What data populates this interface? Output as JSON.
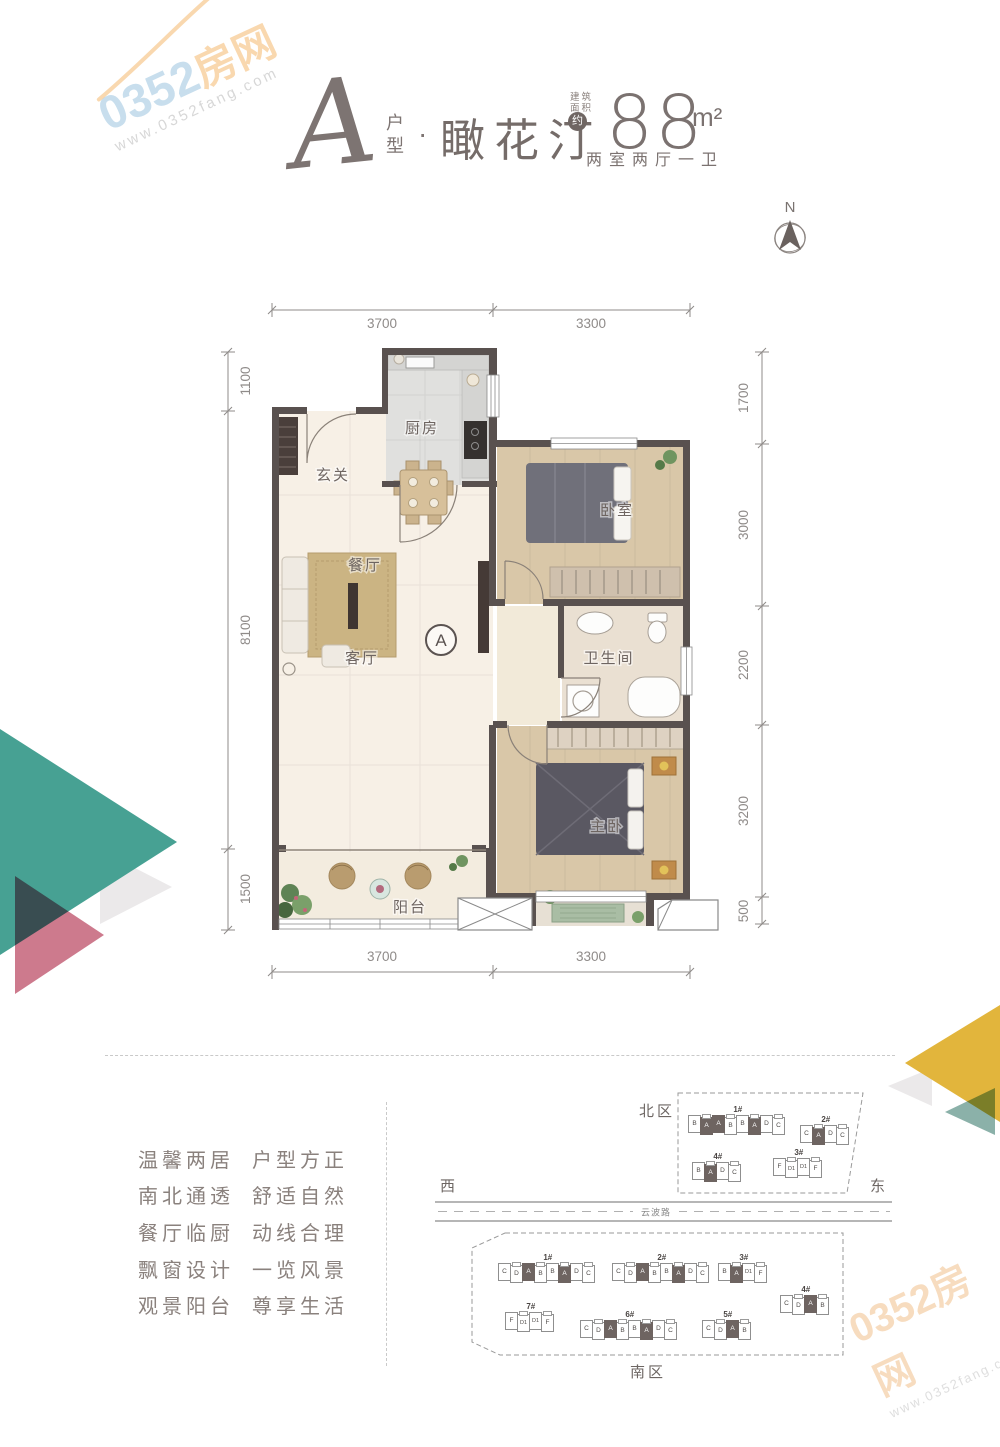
{
  "watermark": {
    "brand_num": "0352",
    "brand_cn": "房网",
    "url": "www.0352fang.com"
  },
  "header": {
    "unit_letter": "A",
    "unit_label_line1": "户",
    "unit_label_line2": "型",
    "separator": "·",
    "name": "瞰花汀",
    "area_note_line1": "建筑",
    "area_note_line2": "面积",
    "approx": "约",
    "area_value": "88",
    "area_unit": "m²",
    "layout_text": "两室两厅一卫"
  },
  "compass": {
    "north": "N"
  },
  "plan": {
    "rooms": {
      "kitchen": "厨房",
      "entry": "玄关",
      "dining": "餐厅",
      "living": "客厅",
      "bedroom": "卧室",
      "bath": "卫生间",
      "master": "主卧",
      "balcony": "阳台",
      "marker": "A"
    },
    "dims": {
      "top": [
        "3700",
        "3300"
      ],
      "bottom": [
        "3700",
        "3300"
      ],
      "left": [
        "1100",
        "8100",
        "1500"
      ],
      "right": [
        "1700",
        "3000",
        "2200",
        "3200",
        "500"
      ]
    }
  },
  "features": {
    "rows": [
      {
        "l": "温馨两居",
        "r": "户型方正"
      },
      {
        "l": "南北通透",
        "r": "舒适自然"
      },
      {
        "l": "餐厅临厨",
        "r": "动线合理"
      },
      {
        "l": "飘窗设计",
        "r": "一览风景"
      },
      {
        "l": "观景阳台",
        "r": "尊享生活"
      }
    ]
  },
  "site": {
    "west": "西",
    "east": "东",
    "road": "云波路",
    "north": {
      "label": "北区",
      "buildings": [
        {
          "num": "1#",
          "x": 258,
          "y": 30,
          "units": [
            "B",
            "A",
            "A",
            "B",
            "B",
            "A",
            "D",
            "C"
          ]
        },
        {
          "num": "2#",
          "x": 370,
          "y": 40,
          "units": [
            "C",
            "A",
            "D",
            "C"
          ]
        },
        {
          "num": "4#",
          "x": 262,
          "y": 77,
          "units": [
            "B",
            "A",
            "D",
            "C"
          ]
        },
        {
          "num": "3#",
          "x": 343,
          "y": 73,
          "units": [
            "F",
            "D1",
            "D1",
            "F"
          ]
        }
      ]
    },
    "south": {
      "label": "南区",
      "buildings": [
        {
          "num": "1#",
          "x": 68,
          "y": 178,
          "units": [
            "C",
            "D",
            "A",
            "B",
            "B",
            "A",
            "D",
            "C"
          ]
        },
        {
          "num": "2#",
          "x": 182,
          "y": 178,
          "units": [
            "C",
            "D",
            "A",
            "B",
            "B",
            "A",
            "D",
            "C"
          ]
        },
        {
          "num": "3#",
          "x": 288,
          "y": 178,
          "units": [
            "B",
            "A",
            "D1",
            "F"
          ]
        },
        {
          "num": "4#",
          "x": 350,
          "y": 210,
          "units": [
            "C",
            "D",
            "A",
            "B"
          ]
        },
        {
          "num": "7#",
          "x": 75,
          "y": 227,
          "units": [
            "F",
            "D1",
            "D1",
            "F"
          ]
        },
        {
          "num": "6#",
          "x": 150,
          "y": 235,
          "units": [
            "C",
            "D",
            "A",
            "B",
            "B",
            "A",
            "D",
            "C"
          ]
        },
        {
          "num": "5#",
          "x": 272,
          "y": 235,
          "units": [
            "C",
            "D",
            "A",
            "B"
          ]
        }
      ]
    }
  }
}
